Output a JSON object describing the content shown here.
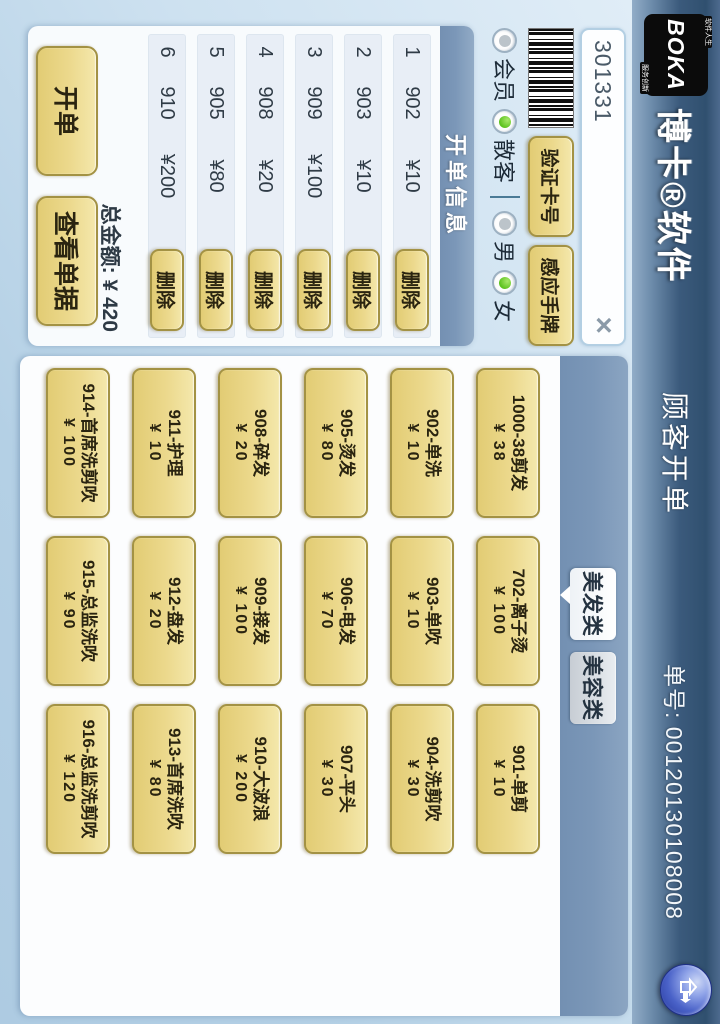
{
  "header": {
    "logo_text": "BOKA",
    "logo_tag_top": "软件人生",
    "logo_tag_bottom": "服务创新",
    "brand": "博卡®软件",
    "title": "顾客开单",
    "order_label": "单号: 00120130108008"
  },
  "member_bar": {
    "card_input_value": "301331",
    "clear_icon": "×",
    "verify_button": "验证卡号",
    "sense_button": "感应手牌",
    "radio_groups": [
      [
        {
          "label": "会员",
          "selected": false
        },
        {
          "label": "散客",
          "selected": true
        }
      ],
      [
        {
          "label": "男",
          "selected": false
        },
        {
          "label": "女",
          "selected": true
        }
      ]
    ]
  },
  "order_panel": {
    "title": "开单信息",
    "delete_label": "删除",
    "rows": [
      {
        "index": "1",
        "code": "902",
        "price": "¥10"
      },
      {
        "index": "2",
        "code": "903",
        "price": "¥10"
      },
      {
        "index": "3",
        "code": "909",
        "price": "¥100"
      },
      {
        "index": "4",
        "code": "908",
        "price": "¥20"
      },
      {
        "index": "5",
        "code": "905",
        "price": "¥80"
      },
      {
        "index": "6",
        "code": "910",
        "price": "¥200"
      }
    ],
    "total_label": "总金额: ¥ 420",
    "open_button": "开单",
    "view_button": "查看单据"
  },
  "categories": {
    "tabs": [
      {
        "label": "美发类",
        "active": true
      },
      {
        "label": "美容类",
        "active": false
      }
    ]
  },
  "services": {
    "rows": [
      [
        {
          "name": "1000-38剪发",
          "price": "¥ 38"
        },
        {
          "name": "702-离子烫",
          "price": "¥ 100"
        },
        {
          "name": "901-单剪",
          "price": "¥ 10"
        }
      ],
      [
        {
          "name": "902-单洗",
          "price": "¥ 10"
        },
        {
          "name": "903-单吹",
          "price": "¥ 10"
        },
        {
          "name": "904-洗剪吹",
          "price": "¥ 30"
        }
      ],
      [
        {
          "name": "905-烫发",
          "price": "¥ 80"
        },
        {
          "name": "906-电发",
          "price": "¥ 70"
        },
        {
          "name": "907-平头",
          "price": "¥ 30"
        }
      ],
      [
        {
          "name": "908-碎发",
          "price": "¥ 20"
        },
        {
          "name": "909-接发",
          "price": "¥ 100"
        },
        {
          "name": "910-大波浪",
          "price": "¥ 200"
        }
      ],
      [
        {
          "name": "911-护理",
          "price": "¥ 10"
        },
        {
          "name": "912-盘发",
          "price": "¥ 20"
        },
        {
          "name": "913-首席洗吹",
          "price": "¥ 80"
        }
      ],
      [
        {
          "name": "914-首席洗剪吹",
          "price": "¥ 100"
        },
        {
          "name": "915-总监洗吹",
          "price": "¥ 90"
        },
        {
          "name": "916-总监洗剪吹",
          "price": "¥ 120"
        }
      ]
    ]
  },
  "colors": {
    "header_top": "#30506f",
    "header_bottom": "#92adc8",
    "panel_blue": "#7b97b8",
    "button_yellow": "#ecd98d",
    "button_border": "#a39244",
    "radio_on_green": "#5cc21e",
    "background_blue": "#cde1f0"
  }
}
